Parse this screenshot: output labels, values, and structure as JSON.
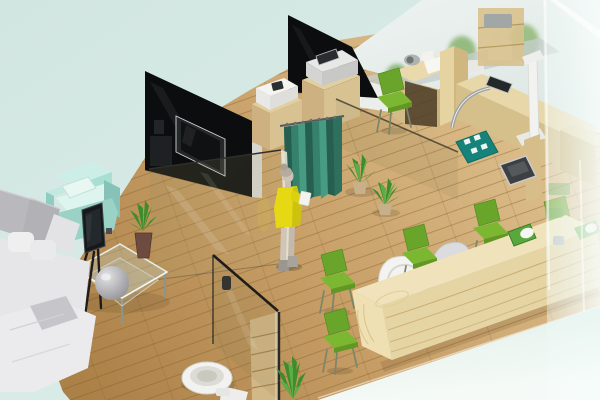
{
  "scene": {
    "description": "Isometric 3D render of a small office clinic interior with waiting lounge, curtained exam room, medical equipment desks, reception counter with green chairs, and a washroom behind glass",
    "style": "3d-isometric-cutaway-render",
    "objects": [
      {
        "id": "waiting-sofa",
        "label": "white L-shaped sofa with gray cushions",
        "color": "#e9e9eb"
      },
      {
        "id": "mint-armchair",
        "label": "mint cube armchair with pillow",
        "color": "#a9ded2"
      },
      {
        "id": "display-easel",
        "label": "dark flat screen on tripod stand",
        "color": "#16191b"
      },
      {
        "id": "glass-coffee-table",
        "label": "glass coffee table with aloe vase",
        "color": "#c3d2c8"
      },
      {
        "id": "partition-walls",
        "label": "black glass partition walls",
        "color": "#0b0d0e"
      },
      {
        "id": "wall-tv",
        "label": "wall mounted television",
        "color": "#0f1112"
      },
      {
        "id": "cabinets-printers",
        "label": "wooden cabinets with white printers",
        "color": "#e2cfa0"
      },
      {
        "id": "exam-curtain",
        "label": "teal privacy curtain on rail",
        "color": "#35816c"
      },
      {
        "id": "person",
        "label": "woman in yellow dress holding paper",
        "color": "#e6d813"
      },
      {
        "id": "potted-plants",
        "label": "potted aloe plants on floor",
        "color": "#3f8c2c"
      },
      {
        "id": "exam-desks",
        "label": "wooden exam desks with towels, tablet and devices",
        "color": "#ead9ab"
      },
      {
        "id": "height-scale",
        "label": "white measuring stand with dark floor scale",
        "color": "#f2f2f0"
      },
      {
        "id": "teal-floor-mat",
        "label": "teal mat with white pads",
        "color": "#15837a"
      },
      {
        "id": "reception-desk",
        "label": "long layered wooden reception counter",
        "color": "#e6d5a4"
      },
      {
        "id": "visitor-chairs",
        "label": "green visitor chairs",
        "color": "#6aa52b"
      },
      {
        "id": "staff-chairs",
        "label": "white and gray tub chairs",
        "color": "#f3f3f1"
      },
      {
        "id": "toilet",
        "label": "toilet beside glass partition",
        "color": "#f2f2f0"
      },
      {
        "id": "wood-shelf",
        "label": "wooden shelf unit behind washroom glass",
        "color": "#d3b887"
      },
      {
        "id": "frosted-glass",
        "label": "frosted glass foreground panes",
        "color": "#f2faf8"
      },
      {
        "id": "wood-floor",
        "label": "light oak plank floor",
        "color": "#c79e66"
      }
    ]
  },
  "palette": {
    "mint_background": "#d5e8e3",
    "floor_light": "#e0c492",
    "floor_dark": "#ab8148",
    "wall_black": "#0b0d0e",
    "curtain_teal": "#35816c",
    "curtain_dark": "#265f50",
    "curtain_light": "#479b82",
    "dress_yellow": "#e6d813",
    "skin": "#cdc3b6",
    "hair": "#b0a797",
    "sofa_white": "#e6e6e8",
    "sofa_gray": "#b9b9bd",
    "armchair_mint": "#a9ded2",
    "chair_green_back": "#6aa52b",
    "chair_green_seat": "#7cb732",
    "desk_wood_top": "#ead9ab",
    "desk_front_wood": "#e6d5a4",
    "mat_teal": "#15837a",
    "equipment_white": "#f2f2f0",
    "tv_black": "#16191b",
    "plant_green": "#3f8c2c",
    "plant_green_light": "#5aae45",
    "frost_white": "#f2faf8",
    "band_aqua": "#e7f5f1",
    "toilet_white": "#f2f2f0",
    "vase_brown": "#6e4b40",
    "chrome": "#9aa0a3"
  }
}
